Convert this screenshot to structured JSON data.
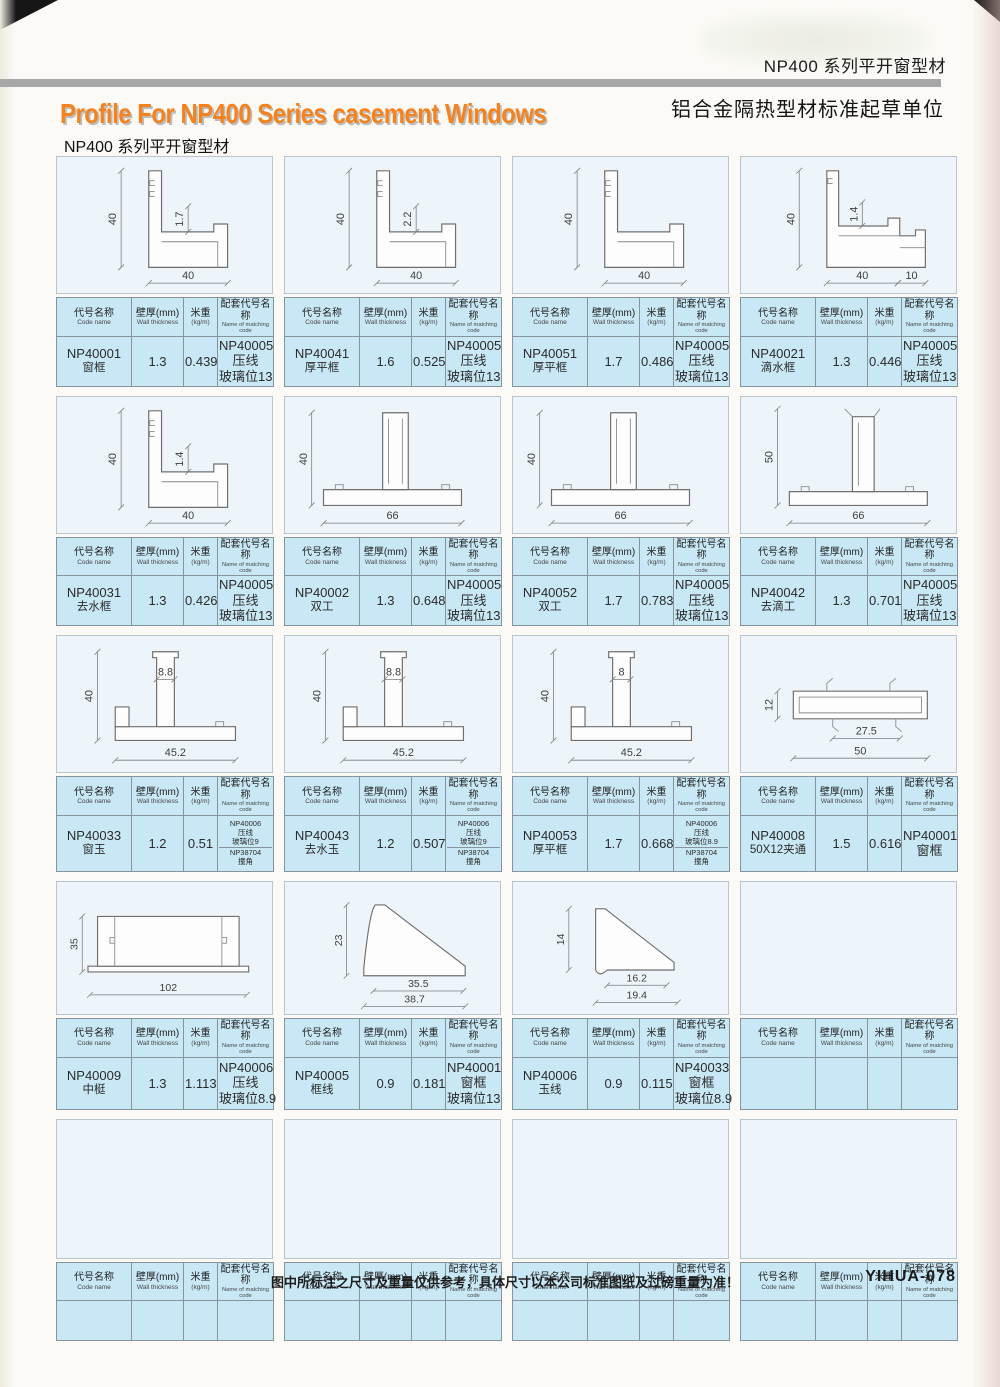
{
  "page": {
    "header_right_top": "NP400 系列平开窗型材",
    "header_right_bottom": "铝合金隔热型材标准起草单位",
    "title_en": "Profile For NP400 Series casement Windows",
    "title_cn": "NP400 系列平开窗型材",
    "footer_note": "图中所标注之尺寸及重量仅供参考，具体尺寸以本公司标准图纸及过磅重量为准！",
    "page_code": "YIHUA-078"
  },
  "table_headers": {
    "code": {
      "cn": "代号名称",
      "en": "Code name"
    },
    "wall": {
      "cn": "壁厚(mm)",
      "en": "Wall thickness"
    },
    "weight": {
      "cn": "米重",
      "en": "(kg/m)"
    },
    "matching": {
      "cn": "配套代号名称",
      "en": "Name of matching code"
    }
  },
  "colors": {
    "accent_orange": "#f5821f",
    "table_fill": "#c9e8f6",
    "panel_fill": "#eef5fa",
    "divider_gray": "#a7a7a7"
  },
  "cells": [
    {
      "code": "NP40001",
      "name": "窗框",
      "wall": "1.3",
      "weight": "0.439",
      "matching": [
        [
          "NP40005",
          "压线",
          "玻璃位13"
        ]
      ],
      "shape": "frameL",
      "dims": {
        "v": "40",
        "t": "1.7",
        "h": "40"
      }
    },
    {
      "code": "NP40041",
      "name": "厚平框",
      "wall": "1.6",
      "weight": "0.525",
      "matching": [
        [
          "NP40005",
          "压线",
          "玻璃位13"
        ]
      ],
      "shape": "frameL",
      "dims": {
        "v": "40",
        "t": "2.2",
        "h": "40"
      }
    },
    {
      "code": "NP40051",
      "name": "厚平框",
      "wall": "1.7",
      "weight": "0.486",
      "matching": [
        [
          "NP40005",
          "压线",
          "玻璃位13"
        ]
      ],
      "shape": "frameL",
      "dims": {
        "v": "40",
        "h": "40"
      }
    },
    {
      "code": "NP40021",
      "name": "滴水框",
      "wall": "1.3",
      "weight": "0.446",
      "matching": [
        [
          "NP40005",
          "压线",
          "玻璃位13"
        ]
      ],
      "shape": "dripL",
      "dims": {
        "v": "40",
        "t": "1.4",
        "h": "40",
        "h2": "10"
      }
    },
    {
      "code": "NP40031",
      "name": "去水框",
      "wall": "1.3",
      "weight": "0.426",
      "matching": [
        [
          "NP40005",
          "压线",
          "玻璃位13"
        ]
      ],
      "shape": "frameL",
      "dims": {
        "v": "40",
        "t": "1.4",
        "h": "40"
      }
    },
    {
      "code": "NP40002",
      "name": "双工",
      "wall": "1.3",
      "weight": "0.648",
      "matching": [
        [
          "NP40005",
          "压线",
          "玻璃位13"
        ]
      ],
      "shape": "tee",
      "dims": {
        "v": "40",
        "h": "66"
      }
    },
    {
      "code": "NP40052",
      "name": "双工",
      "wall": "1.7",
      "weight": "0.783",
      "matching": [
        [
          "NP40005",
          "压线",
          "玻璃位13"
        ]
      ],
      "shape": "tee",
      "dims": {
        "v": "40",
        "h": "66"
      }
    },
    {
      "code": "NP40042",
      "name": "去滴工",
      "wall": "1.3",
      "weight": "0.701",
      "matching": [
        [
          "NP40005",
          "压线",
          "玻璃位13"
        ]
      ],
      "shape": "tee50",
      "dims": {
        "v": "50",
        "h": "66"
      }
    },
    {
      "code": "NP40033",
      "name": "窗玉",
      "wall": "1.2",
      "weight": "0.51",
      "matching": [
        [
          "NP40006",
          "压线",
          "玻璃位9"
        ],
        [
          "NP38704",
          "撞角"
        ]
      ],
      "shape": "glaz",
      "dims": {
        "v": "40",
        "w": "8.8",
        "h": "45.2"
      }
    },
    {
      "code": "NP40043",
      "name": "去水玉",
      "wall": "1.2",
      "weight": "0.507",
      "matching": [
        [
          "NP40006",
          "压线",
          "玻璃位9"
        ],
        [
          "NP38704",
          "撞角"
        ]
      ],
      "shape": "glaz",
      "dims": {
        "v": "40",
        "w": "8.8",
        "h": "45.2"
      }
    },
    {
      "code": "NP40053",
      "name": "厚平框",
      "wall": "1.7",
      "weight": "0.668",
      "matching": [
        [
          "NP40006",
          "压线",
          "玻璃位8.9"
        ],
        [
          "NP38704",
          "撞角"
        ]
      ],
      "shape": "glaz",
      "dims": {
        "v": "40",
        "w": "8",
        "h": "45.2"
      }
    },
    {
      "code": "NP40008",
      "name": "50X12夹通",
      "wall": "1.5",
      "weight": "0.616",
      "matching": [
        [
          "NP40001",
          "窗框"
        ]
      ],
      "shape": "tube",
      "dims": {
        "v": "12",
        "w": "27.5",
        "h": "50"
      }
    },
    {
      "code": "NP40009",
      "name": "中梃",
      "wall": "1.3",
      "weight": "1.113",
      "matching": [
        [
          "NP40006",
          "压线",
          "玻璃位8.9"
        ]
      ],
      "shape": "box",
      "dims": {
        "v": "35",
        "h": "102"
      }
    },
    {
      "code": "NP40005",
      "name": "框线",
      "wall": "0.9",
      "weight": "0.181",
      "matching": [
        [
          "NP40001",
          "窗框",
          "玻璃位13"
        ]
      ],
      "shape": "bead",
      "dims": {
        "v": "23",
        "w": "35.5",
        "h": "38.7"
      }
    },
    {
      "code": "NP40006",
      "name": "玉线",
      "wall": "0.9",
      "weight": "0.115",
      "matching": [
        [
          "NP40033",
          "窗框",
          "玻璃位8.9"
        ]
      ],
      "shape": "beadsm",
      "dims": {
        "v": "14",
        "w": "16.2",
        "h": "19.4"
      }
    },
    {
      "empty": true
    },
    {
      "empty": true
    },
    {
      "empty": true
    },
    {
      "empty": true
    },
    {
      "empty": true
    }
  ]
}
